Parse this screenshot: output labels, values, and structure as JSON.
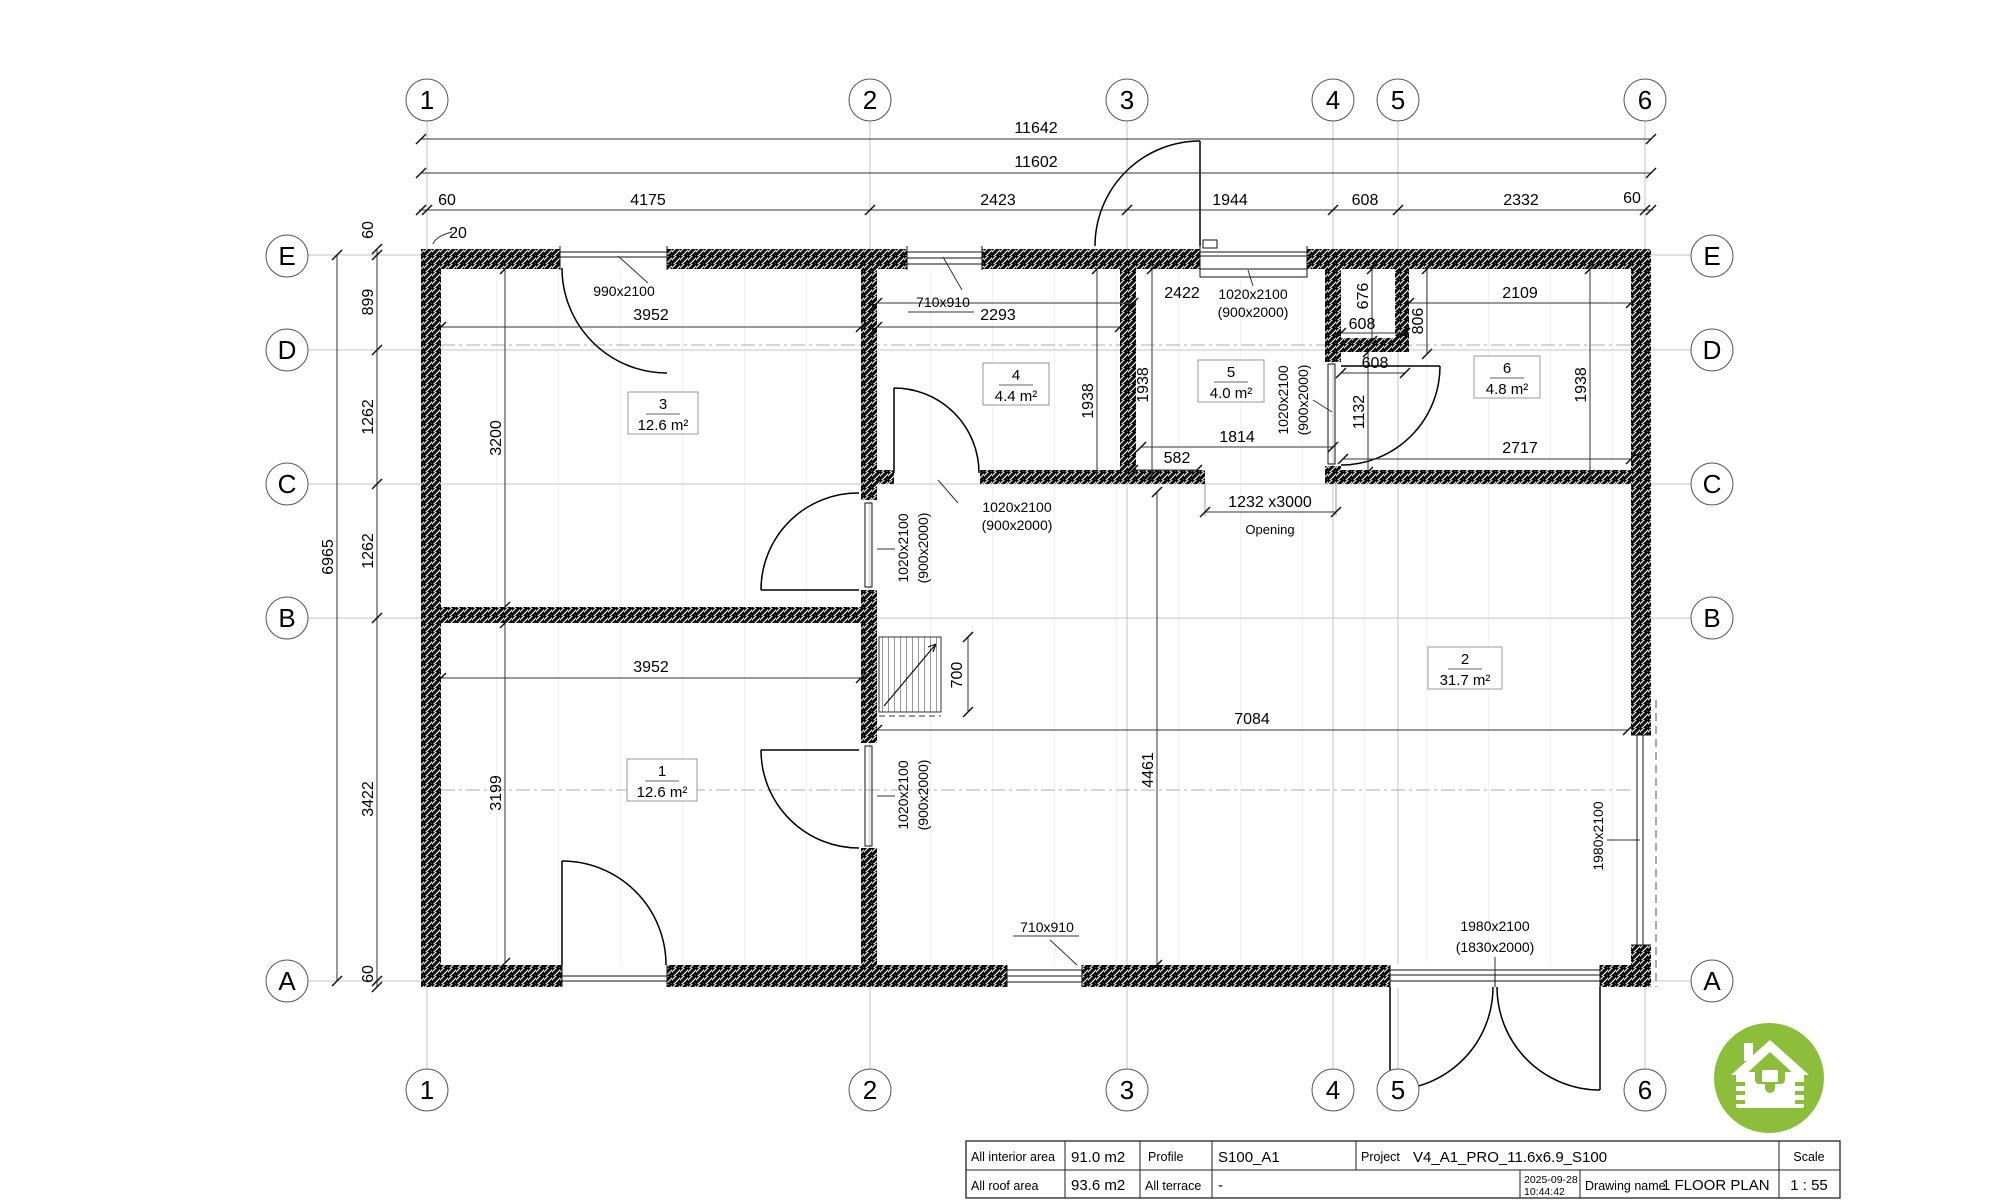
{
  "axes": {
    "cols": [
      "1",
      "2",
      "3",
      "4",
      "5",
      "6"
    ],
    "rows": [
      "E",
      "D",
      "C",
      "B",
      "A"
    ]
  },
  "dims": {
    "top": {
      "total": "11642",
      "overall": "11602",
      "segments": [
        "60",
        "4175",
        "2423",
        "1944",
        "608",
        "2332",
        "60"
      ],
      "offset": "20"
    },
    "left": {
      "total": "6965",
      "segments": [
        "60",
        "899",
        "1262",
        "1262",
        "3422",
        "60"
      ]
    },
    "interior": {
      "room3_width": "3952",
      "room3_height": "3200",
      "room4_width": "2293",
      "room4_height": "1938",
      "room5_left_height": "1938",
      "room5_width": "1814",
      "hall_top_width": "2422",
      "wall_gap": "582",
      "opening_size": "1232 x3000",
      "opening_label": "Opening",
      "niche_height": "676",
      "niche_width": "608",
      "niche_depth": "806",
      "room6_top_width": "2109",
      "hall_width": "608",
      "hall_height": "1132",
      "room6_bottom_width": "2717",
      "room6_height": "1938",
      "room1_width": "3952",
      "room1_height": "3199",
      "stair_width": "700",
      "room2_width": "7084",
      "room2_height": "4461"
    }
  },
  "openings": {
    "door_990": "990x2100",
    "window_710": "710x910",
    "door_1020": "1020x2100",
    "door_1020_sub": "(900x2000)",
    "door_1980": "1980x2100",
    "door_1980_sub": "(1830x2000)"
  },
  "rooms": [
    {
      "num": "1",
      "area": "12.6 m²"
    },
    {
      "num": "2",
      "area": "31.7 m²"
    },
    {
      "num": "3",
      "area": "12.6 m²"
    },
    {
      "num": "4",
      "area": "4.4 m²"
    },
    {
      "num": "5",
      "area": "4.0 m²"
    },
    {
      "num": "6",
      "area": "4.8 m²"
    }
  ],
  "titleblock": {
    "interior_label": "All interior area",
    "interior_value": "91.0 m2",
    "roof_label": "All roof area",
    "roof_value": "93.6 m2",
    "profile_label": "Profile",
    "profile_value": "S100_A1",
    "terrace_label": "All terrace",
    "terrace_value": "-",
    "date": "2025-09-28",
    "time": "10:44:42",
    "project_label": "Project",
    "project_value": "V4_A1_PRO_11.6x6.9_S100",
    "drawing_label": "Drawing name",
    "drawing_value": "1 FLOOR PLAN",
    "scale_label": "Scale",
    "scale_value": "1 : 55"
  },
  "logo_color": "#8cbe3c"
}
